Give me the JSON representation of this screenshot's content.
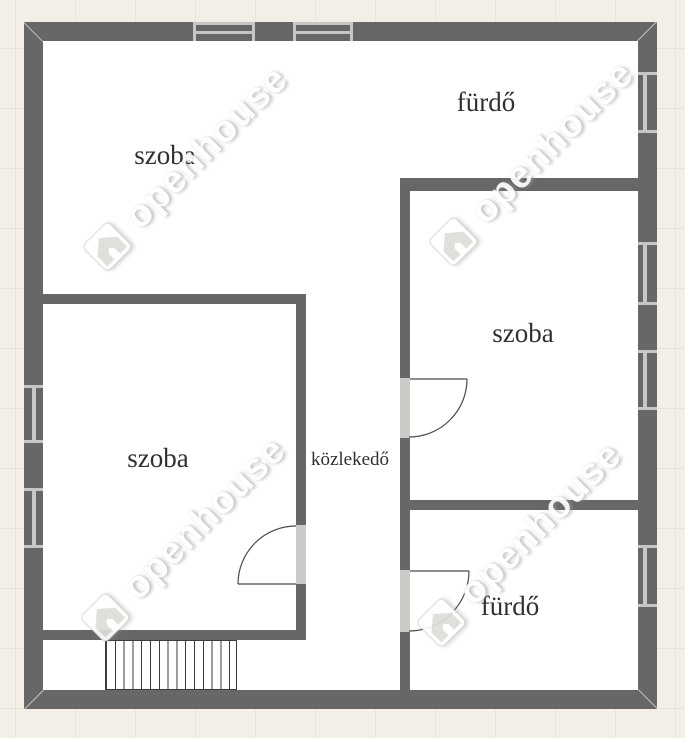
{
  "plan": {
    "labels": [
      {
        "id": "room-top-left",
        "text": "szoba"
      },
      {
        "id": "bath-top-right",
        "text": "fürdő"
      },
      {
        "id": "room-mid-right",
        "text": "szoba"
      },
      {
        "id": "room-bottom-left",
        "text": "szoba"
      },
      {
        "id": "corridor",
        "text": "közlekedő"
      },
      {
        "id": "bath-bottom-right",
        "text": "fürdő"
      }
    ],
    "features": {
      "windows": 8,
      "doors": 3,
      "stair_treads": 15
    }
  },
  "watermark": {
    "text": "openhouse"
  },
  "colors": {
    "bg": "#f3efe6",
    "grid": "#e7e3d9",
    "wall": "#676767",
    "interior": "#ffffff",
    "winlight": "#c9c7c4",
    "jamb": "#cccac7",
    "label": "#303030",
    "doorline": "#4a4a4a"
  }
}
